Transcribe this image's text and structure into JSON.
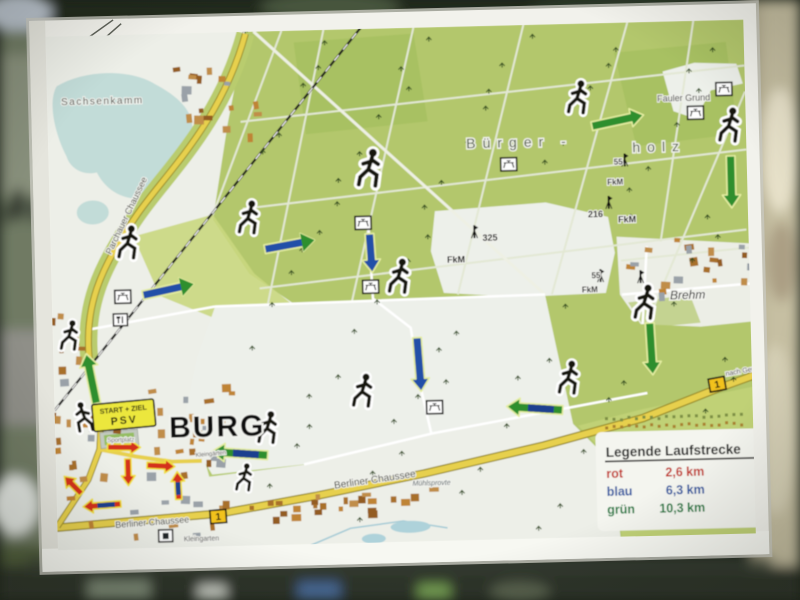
{
  "legend": {
    "title": "Legende Laufstrecke",
    "items": [
      {
        "name": "rot",
        "value": "2,6 km",
        "color": "#c23026"
      },
      {
        "name": "blau",
        "value": "6,3 km",
        "color": "#2a55a0"
      },
      {
        "name": "grün",
        "value": "10,3 km",
        "color": "#15793c"
      }
    ]
  },
  "map": {
    "start_box": {
      "line1": "START + ZIEL",
      "line2": "PSV"
    },
    "labels": [
      {
        "text": "Sachsenkamm",
        "x": 66,
        "y": 97,
        "size": 10,
        "color": "#4a4f4a",
        "ls": 1.5
      },
      {
        "text": "Bürger -",
        "x": 470,
        "y": 150,
        "size": 14,
        "color": "#3f4f30",
        "ls": 7
      },
      {
        "text": "holz",
        "x": 636,
        "y": 158,
        "size": 14,
        "color": "#3f4f30",
        "ls": 7
      },
      {
        "text": "Fauler Grund",
        "x": 662,
        "y": 108,
        "size": 9,
        "color": "#333333"
      },
      {
        "text": "Brehm",
        "x": 670,
        "y": 306,
        "size": 12,
        "color": "#222222",
        "italic": true
      },
      {
        "text": "BURG",
        "x": 166,
        "y": 432,
        "size": 30,
        "color": "#0a0a0a",
        "bold": true,
        "ls": 2
      },
      {
        "text": "Sportplatz",
        "x": 104,
        "y": 435,
        "size": 6,
        "color": "#555555"
      },
      {
        "text": "Berliner Chaussee",
        "x": 330,
        "y": 487,
        "size": 10,
        "color": "#3a3a30",
        "rot": -7
      },
      {
        "text": "Berliner Chaussee",
        "x": 110,
        "y": 521,
        "size": 9,
        "color": "#3a3a30",
        "rot": -3
      },
      {
        "text": "nach Genthin",
        "x": 724,
        "y": 384,
        "size": 7,
        "color": "#333333",
        "rot": -9
      },
      {
        "text": "Parchauer Chaussee",
        "x": 112,
        "y": 248,
        "size": 9,
        "color": "#3a3a30",
        "rot": -63
      },
      {
        "text": "Kleingarten",
        "x": 178,
        "y": 536,
        "size": 7,
        "color": "#555555"
      },
      {
        "text": "Kleingärten",
        "x": 192,
        "y": 452,
        "size": 6,
        "color": "#555555",
        "rot": -4
      },
      {
        "text": "Mühlsprovte",
        "x": 408,
        "y": 486,
        "size": 7,
        "color": "#556066",
        "italic": true
      },
      {
        "text": "325",
        "x": 484,
        "y": 243,
        "size": 9,
        "color": "#111111",
        "bold": true
      },
      {
        "text": "FkM",
        "x": 448,
        "y": 264,
        "size": 9,
        "color": "#111111",
        "bold": true
      },
      {
        "text": "216",
        "x": 590,
        "y": 222,
        "size": 9,
        "color": "#111111",
        "bold": true
      },
      {
        "text": "FkM",
        "x": 620,
        "y": 228,
        "size": 9,
        "color": "#111111",
        "bold": true
      },
      {
        "text": "55",
        "x": 592,
        "y": 283,
        "size": 8,
        "color": "#111111",
        "bold": true
      },
      {
        "text": "FkM",
        "x": 582,
        "y": 297,
        "size": 8,
        "color": "#111111",
        "bold": true
      },
      {
        "text": "55",
        "x": 617,
        "y": 170,
        "size": 8,
        "color": "#111111",
        "bold": true
      },
      {
        "text": "FkM",
        "x": 610,
        "y": 190,
        "size": 8,
        "color": "#111111",
        "bold": true
      }
    ],
    "road_badges": [
      {
        "text": "1",
        "x": 213,
        "y": 512,
        "rot": -3
      },
      {
        "text": "1",
        "x": 715,
        "y": 392,
        "rot": -9
      }
    ],
    "markers": [
      {
        "type": "runner",
        "x": 131,
        "y": 252,
        "s": 1.45
      },
      {
        "type": "runner",
        "x": 252,
        "y": 230,
        "s": 1.45
      },
      {
        "type": "runner",
        "x": 374,
        "y": 186,
        "s": 1.65
      },
      {
        "type": "runner",
        "x": 401,
        "y": 293,
        "s": 1.5
      },
      {
        "type": "runner",
        "x": 584,
        "y": 118,
        "s": 1.45
      },
      {
        "type": "runner",
        "x": 735,
        "y": 150,
        "s": 1.5
      },
      {
        "type": "runner",
        "x": 646,
        "y": 325,
        "s": 1.5
      },
      {
        "type": "runner",
        "x": 568,
        "y": 398,
        "s": 1.45
      },
      {
        "type": "runner",
        "x": 362,
        "y": 406,
        "s": 1.45
      },
      {
        "type": "runner",
        "x": 266,
        "y": 440,
        "s": 1.4
      },
      {
        "type": "runner",
        "x": 70,
        "y": 342,
        "s": 1.3
      },
      {
        "type": "runner",
        "x": 80,
        "y": 424,
        "s": 1.3,
        "flip": true
      },
      {
        "type": "runner",
        "x": 241,
        "y": 487,
        "s": 1.2
      },
      {
        "type": "picnic",
        "x": 512,
        "y": 167
      },
      {
        "type": "picnic",
        "x": 365,
        "y": 222
      },
      {
        "type": "picnic",
        "x": 371,
        "y": 286
      },
      {
        "type": "picnic",
        "x": 729,
        "y": 97
      },
      {
        "type": "picnic",
        "x": 700,
        "y": 120
      },
      {
        "type": "picnic",
        "x": 432,
        "y": 408
      },
      {
        "type": "picnic",
        "x": 123,
        "y": 290
      },
      {
        "type": "forkknife",
        "x": 120,
        "y": 313
      },
      {
        "type": "monument",
        "x": 160,
        "y": 530
      },
      {
        "type": "mast",
        "x": 476,
        "y": 240
      },
      {
        "type": "mast",
        "x": 611,
        "y": 214
      },
      {
        "type": "mast",
        "x": 601,
        "y": 287
      },
      {
        "type": "mast",
        "x": 628,
        "y": 172
      },
      {
        "type": "mast",
        "x": 641,
        "y": 289
      }
    ],
    "arrows": [
      {
        "x1": 143,
        "y1": 289,
        "x2": 194,
        "y2": 279,
        "type": "blue-green"
      },
      {
        "x1": 266,
        "y1": 246,
        "x2": 316,
        "y2": 238,
        "type": "blue-green"
      },
      {
        "x1": 596,
        "y1": 131,
        "x2": 648,
        "y2": 121,
        "type": "green"
      },
      {
        "x1": 734,
        "y1": 164,
        "x2": 734,
        "y2": 216,
        "type": "green"
      },
      {
        "x1": 371,
        "y1": 233,
        "x2": 373,
        "y2": 272,
        "type": "blue"
      },
      {
        "x1": 416,
        "y1": 338,
        "x2": 419,
        "y2": 392,
        "type": "blue"
      },
      {
        "x1": 560,
        "y1": 414,
        "x2": 504,
        "y2": 409,
        "type": "green-blue"
      },
      {
        "x1": 649,
        "y1": 329,
        "x2": 651,
        "y2": 381,
        "type": "green"
      },
      {
        "x1": 94,
        "y1": 396,
        "x2": 85,
        "y2": 346,
        "type": "green"
      },
      {
        "x1": 264,
        "y1": 452,
        "x2": 208,
        "y2": 447,
        "type": "green-blue"
      },
      {
        "x1": 104,
        "y1": 440,
        "x2": 137,
        "y2": 441,
        "type": "red"
      },
      {
        "x1": 124,
        "y1": 452,
        "x2": 124,
        "y2": 479,
        "type": "red"
      },
      {
        "x1": 143,
        "y1": 459,
        "x2": 171,
        "y2": 461,
        "type": "red"
      },
      {
        "x1": 116,
        "y1": 497,
        "x2": 78,
        "y2": 499,
        "type": "red-blue"
      },
      {
        "x1": 174,
        "y1": 494,
        "x2": 173,
        "y2": 466,
        "type": "red-blue"
      },
      {
        "x1": 77,
        "y1": 486,
        "x2": 60,
        "y2": 468,
        "type": "red"
      }
    ]
  },
  "colors": {
    "forest_green": "#b3c76c",
    "field_green": "#c9d77f",
    "open_land": "#edefe8",
    "lake_blue": "#c2dcd8",
    "road_yellow": "#e7d04d",
    "route_red": "#d4321c",
    "route_blue": "#2050a8",
    "route_green": "#2f8f2e",
    "building_brown": "#bf8435",
    "sign_white": "#f2f2ec"
  }
}
